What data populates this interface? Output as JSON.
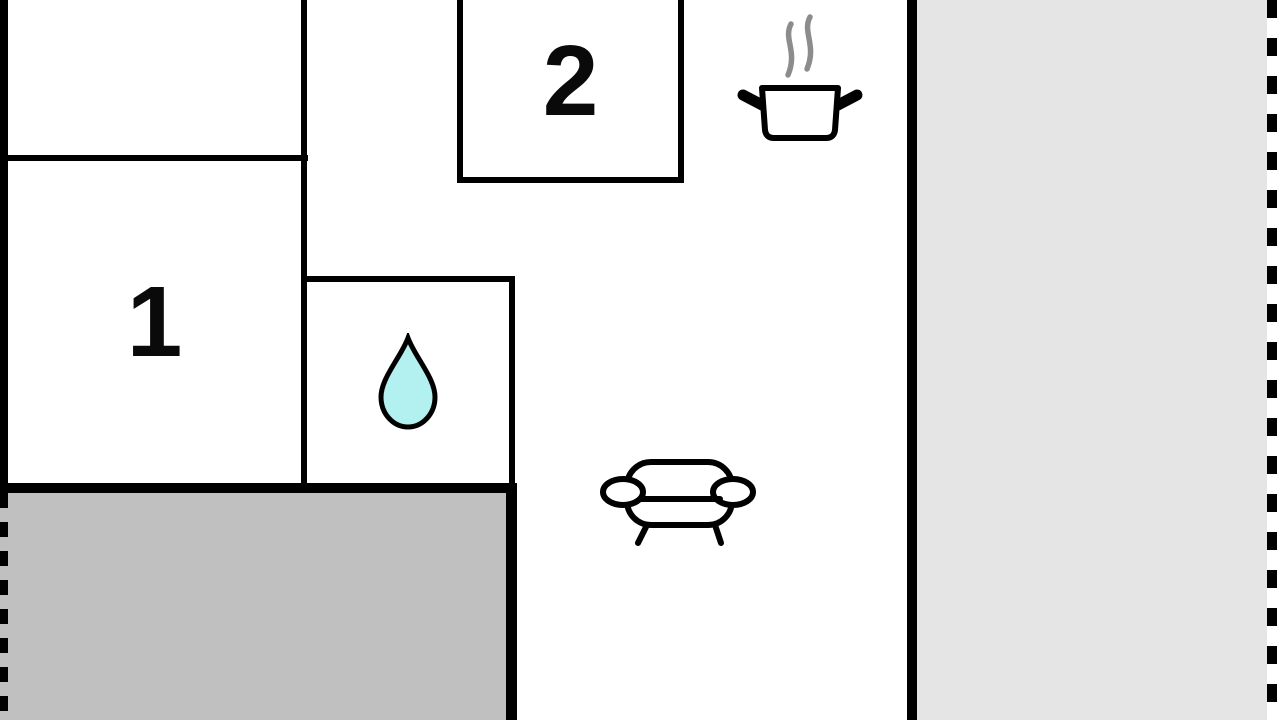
{
  "rooms": {
    "room1": {
      "label": "1"
    },
    "room2": {
      "label": "2"
    }
  },
  "icons": {
    "water_drop": "water-drop-icon",
    "cooking_pot": "cooking-pot-icon",
    "steam": "steam-icon",
    "sofa": "sofa-icon"
  },
  "colors": {
    "wall": "#000000",
    "background": "#ffffff",
    "terrace_left_fill": "#c0c0c0",
    "terrace_right_fill": "#e5e5e5",
    "water_drop_fill": "#b3f0f0",
    "steam_stroke": "#8c8c8c"
  }
}
